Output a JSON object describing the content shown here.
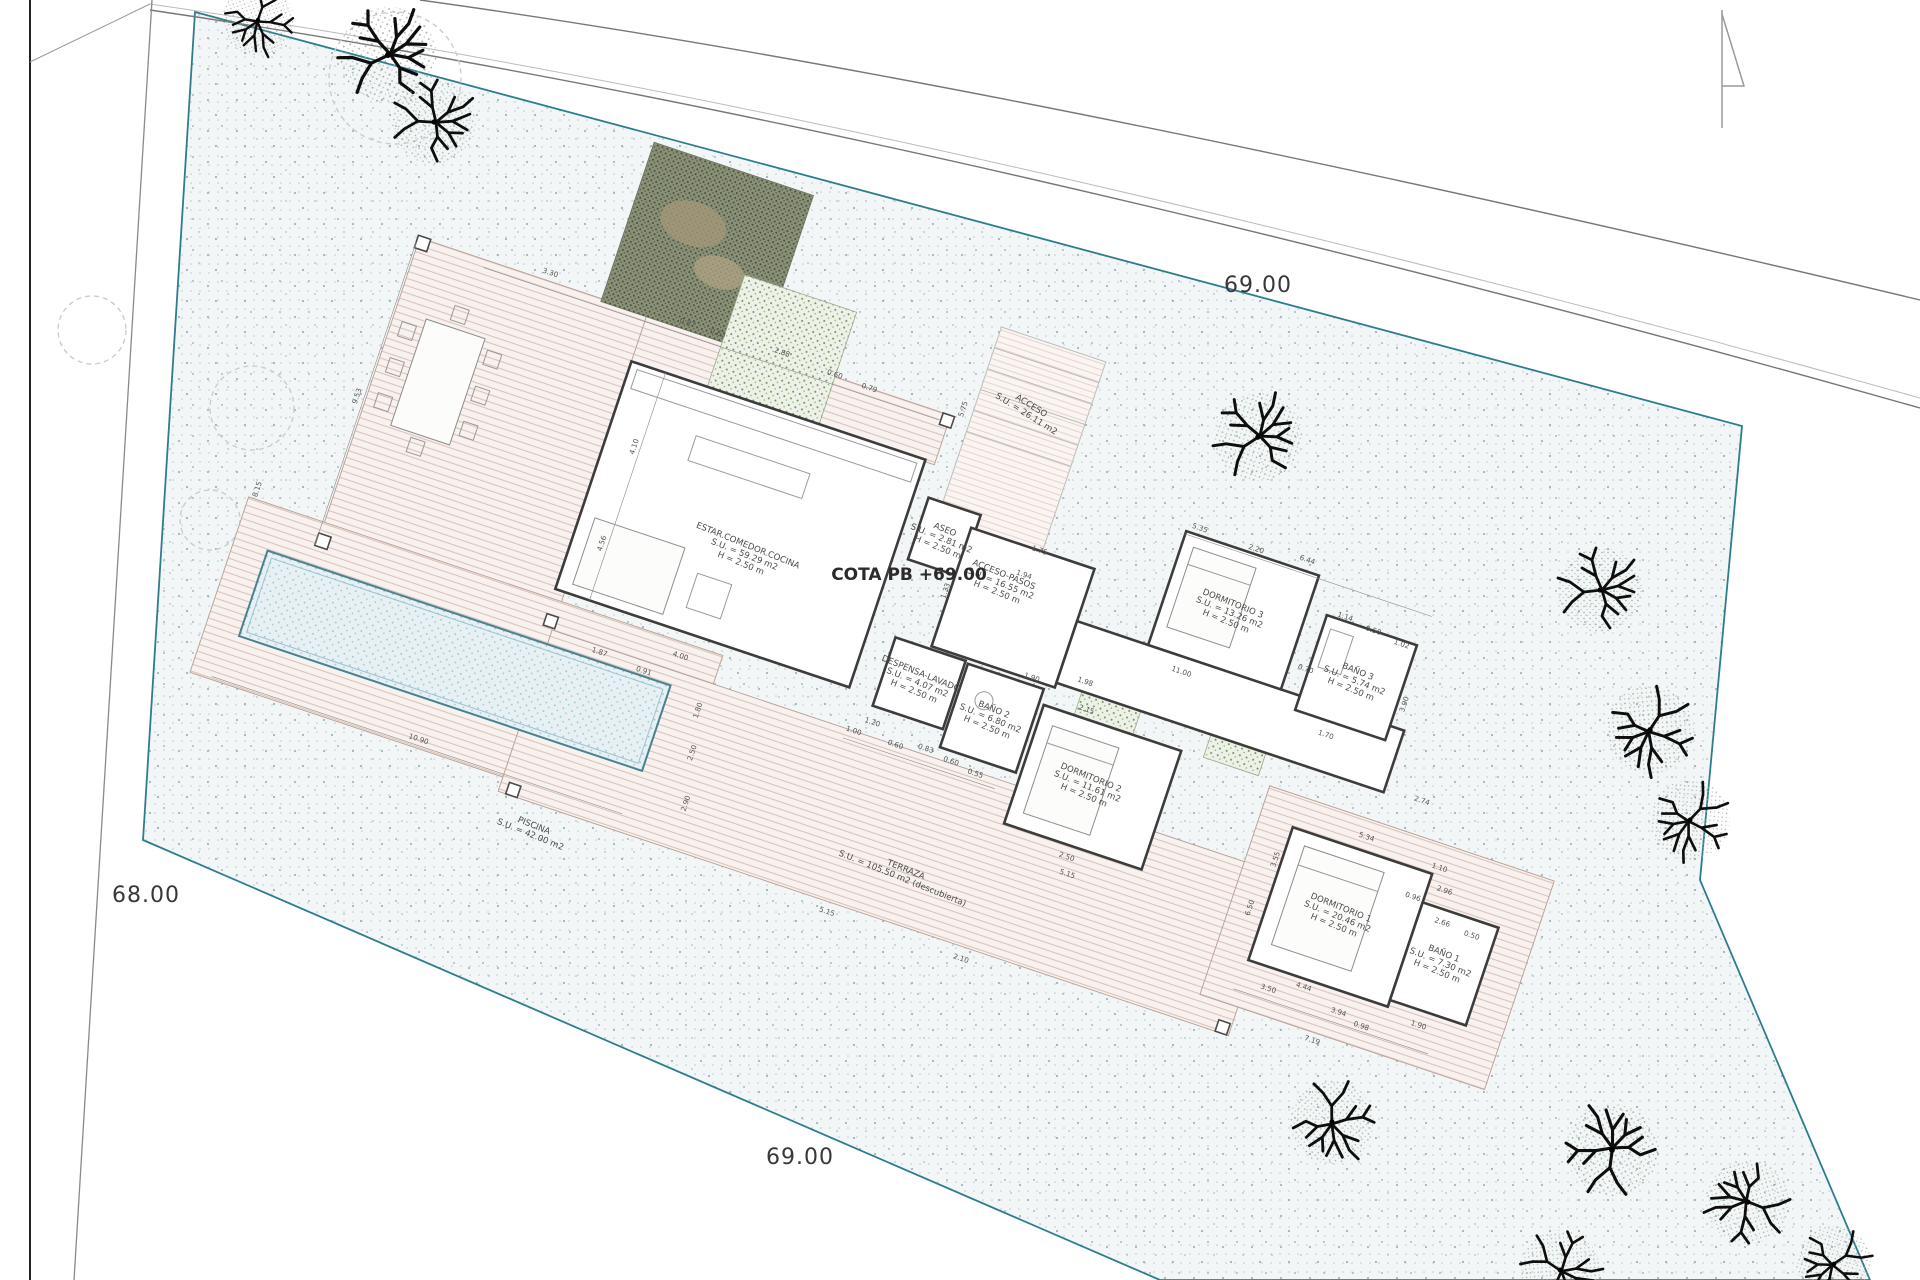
{
  "drawing": {
    "kind": "architectural site plan / ground floor plan",
    "level_label": {
      "text": "COTA PB +69.00",
      "x": 909,
      "y": 580
    },
    "site_labels": [
      {
        "text": "69.00",
        "x": 1258,
        "y": 292
      },
      {
        "text": "68.00",
        "x": 146,
        "y": 902
      },
      {
        "text": "69.00",
        "x": 800,
        "y": 1164
      }
    ],
    "rooms": [
      {
        "id": "estar",
        "lines": [
          "ESTAR.COMEDOR.COCINA",
          "S.U. = 59.29 m2",
          "H = 2.50 m"
        ],
        "x": 747,
        "y": 548,
        "rot": 22
      },
      {
        "id": "aseo",
        "lines": [
          "ASEO",
          "S.U. = 2.81 m2",
          "H = 2.50 m"
        ],
        "x": 944,
        "y": 532,
        "rot": 22
      },
      {
        "id": "acceso-pasos",
        "lines": [
          "ACCESO-PASOS",
          "S.U. = 16.55 m2",
          "H = 2.50 m"
        ],
        "x": 1003,
        "y": 577,
        "rot": 22
      },
      {
        "id": "acceso",
        "lines": [
          "ACCESO",
          "S.U. = 26.11 m2"
        ],
        "x": 1030,
        "y": 408,
        "rot": 32
      },
      {
        "id": "despensa",
        "lines": [
          "DESPENSA-LAVADO",
          "S.U. = 4.07 m2",
          "H = 2.50 m"
        ],
        "x": 920,
        "y": 676,
        "rot": 22
      },
      {
        "id": "bano2",
        "lines": [
          "BAÑO 2",
          "S.U. = 6.80 m2",
          "H = 2.50 m"
        ],
        "x": 993,
        "y": 712,
        "rot": 22
      },
      {
        "id": "dorm2",
        "lines": [
          "DORMITORIO 2",
          "S.U. = 11.61 m2",
          "H = 2.50 m"
        ],
        "x": 1090,
        "y": 780,
        "rot": 22
      },
      {
        "id": "dorm3",
        "lines": [
          "DORMITORIO 3",
          "S.U. = 13.26 m2",
          "H = 2.50 m"
        ],
        "x": 1232,
        "y": 606,
        "rot": 22
      },
      {
        "id": "bano3",
        "lines": [
          "BAÑO 3",
          "S.U. = 5.74 m2",
          "H = 2.50 m"
        ],
        "x": 1357,
        "y": 674,
        "rot": 22
      },
      {
        "id": "dorm1",
        "lines": [
          "DORMITORIO 1",
          "S.U. = 20.46 m2",
          "H = 2.50 m"
        ],
        "x": 1340,
        "y": 910,
        "rot": 22
      },
      {
        "id": "bano1",
        "lines": [
          "BAÑO 1",
          "S.U. = 7.30 m2",
          "H = 2.50 m"
        ],
        "x": 1443,
        "y": 956,
        "rot": 22
      },
      {
        "id": "piscina",
        "lines": [
          "PISCINA",
          "S.U. = 42.00 m2"
        ],
        "x": 533,
        "y": 828,
        "rot": 22
      },
      {
        "id": "terraza",
        "lines": [
          "TERRAZA",
          "S.U. = 105.50 m2 (descubierta)"
        ],
        "x": 905,
        "y": 872,
        "rot": 22
      }
    ],
    "dimensions": [
      [
        "3.30",
        455,
        424,
        0
      ],
      [
        "0.87",
        601,
        428,
        0
      ],
      [
        "0.63",
        633,
        428,
        0
      ],
      [
        "2.88",
        700,
        426,
        0
      ],
      [
        "0.60",
        757,
        430,
        0
      ],
      [
        "0.79",
        794,
        432,
        0
      ],
      [
        "9.53",
        313,
        600,
        -90
      ],
      [
        "8.15",
        248,
        720,
        -90
      ],
      [
        "4.10",
        592,
        560,
        -90
      ],
      [
        "4.56",
        592,
        662,
        -90
      ],
      [
        "4.00",
        700,
        746,
        0
      ],
      [
        "1.87",
        622,
        768,
        0
      ],
      [
        "0.91",
        670,
        772,
        0
      ],
      [
        "1.94",
        1000,
        560,
        0
      ],
      [
        "1.33",
        933,
        598,
        -90
      ],
      [
        "11.00",
        1180,
        602,
        0
      ],
      [
        "1.98",
        1092,
        642,
        0
      ],
      [
        "1.20",
        903,
        748,
        0
      ],
      [
        "1.00",
        888,
        762,
        0
      ],
      [
        "0.60",
        932,
        762,
        0
      ],
      [
        "0.83",
        962,
        756,
        0
      ],
      [
        "0.60",
        990,
        760,
        0
      ],
      [
        "0.55",
        1017,
        764,
        0
      ],
      [
        "1.90",
        1040,
        655,
        0
      ],
      [
        "2.15",
        1102,
        668,
        0
      ],
      [
        "2.50",
        1130,
        814,
        0
      ],
      [
        "5.15",
        1136,
        830,
        0
      ],
      [
        "5.35",
        1152,
        460,
        0
      ],
      [
        "2.20",
        1212,
        462,
        0
      ],
      [
        "6.44",
        1264,
        456,
        0
      ],
      [
        "1.14",
        1318,
        498,
        0
      ],
      [
        "0.50",
        1349,
        502,
        0
      ],
      [
        "1.02",
        1380,
        506,
        0
      ],
      [
        "0.70",
        1297,
        560,
        0
      ],
      [
        "1.70",
        1337,
        616,
        0
      ],
      [
        "3.90",
        1404,
        560,
        -90
      ],
      [
        "2.74",
        1449,
        648,
        0
      ],
      [
        "5.34",
        1408,
        700,
        0
      ],
      [
        "1.10",
        1487,
        706,
        0
      ],
      [
        "3.55",
        1331,
        748,
        -90
      ],
      [
        "6.50",
        1322,
        802,
        -90
      ],
      [
        "2.96",
        1499,
        726,
        0
      ],
      [
        "0.96",
        1471,
        742,
        0
      ],
      [
        "2.66",
        1507,
        757,
        0
      ],
      [
        "0.50",
        1539,
        760,
        0
      ],
      [
        "4.44",
        1396,
        862,
        0
      ],
      [
        "3.50",
        1363,
        875,
        0
      ],
      [
        "3.94",
        1437,
        875,
        0
      ],
      [
        "0.98",
        1463,
        881,
        0
      ],
      [
        "1.90",
        1517,
        862,
        0
      ],
      [
        "7.19",
        1421,
        910,
        0
      ],
      [
        "10.90",
        478,
        908,
        0
      ],
      [
        "1.80",
        736,
        790,
        -90
      ],
      [
        "2.50",
        744,
        832,
        -90
      ],
      [
        "2.90",
        754,
        882,
        -90
      ],
      [
        "5.15",
        920,
        942,
        0
      ],
      [
        "2.10",
        1062,
        944,
        0
      ],
      [
        "5.75",
        892,
        420,
        -90
      ],
      [
        "1.75",
        1007,
        532,
        0
      ]
    ],
    "trees": [
      [
        258,
        20,
        0.85
      ],
      [
        388,
        55,
        1.15
      ],
      [
        434,
        122,
        1.0
      ],
      [
        1258,
        437,
        1.05
      ],
      [
        1600,
        590,
        1.0
      ],
      [
        1650,
        730,
        1.05
      ],
      [
        1690,
        820,
        0.95
      ],
      [
        1332,
        1122,
        1.0
      ],
      [
        1612,
        1150,
        1.1
      ],
      [
        1748,
        1202,
        1.0
      ],
      [
        1834,
        1264,
        0.9
      ],
      [
        1560,
        1270,
        0.95
      ]
    ],
    "outline_trees": [
      [
        395,
        78,
        66
      ],
      [
        252,
        408,
        42
      ],
      [
        92,
        330,
        34
      ],
      [
        210,
        520,
        30
      ]
    ],
    "colors": {
      "boundary": "#2e7d8c",
      "road_line": "#777777",
      "walls": "#3c3c3c",
      "deck_hatch": "#dcc2b8",
      "pool_dot": "#97bfcf",
      "pool_border": "#4a8191",
      "green_dot": "#6f9159",
      "dark_patch": "#8a9178",
      "plot_speckle": "#b9c7cd",
      "text": "#3a3a3a"
    }
  }
}
